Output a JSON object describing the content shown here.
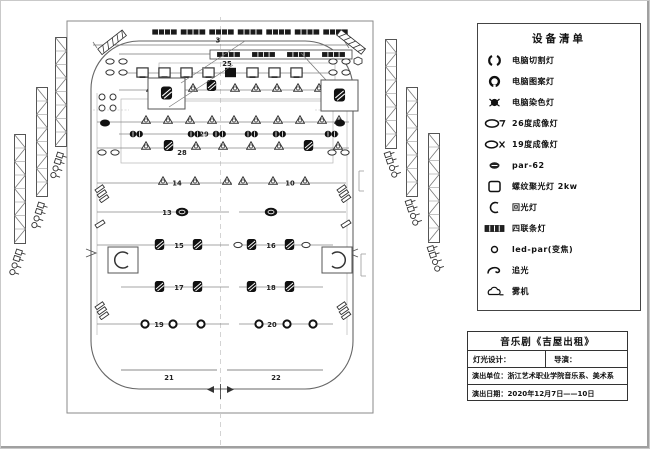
{
  "legend": {
    "title": "设备清单",
    "items": [
      {
        "icon": "computer-cut-light-icon",
        "label": "电脑切割灯"
      },
      {
        "icon": "computer-pattern-light-icon",
        "label": "电脑图案灯"
      },
      {
        "icon": "computer-wash-light-icon",
        "label": "电脑染色灯"
      },
      {
        "icon": "profile-26-deg-icon",
        "label": "26度成像灯"
      },
      {
        "icon": "profile-19-deg-icon",
        "label": "19度成像灯"
      },
      {
        "icon": "par62-icon",
        "label": "par-62"
      },
      {
        "icon": "fresnel-2kw-icon",
        "label": "螺纹聚光灯 2kw"
      },
      {
        "icon": "beam-light-icon",
        "label": "回光灯"
      },
      {
        "icon": "four-cell-strip-icon",
        "label": "四联条灯"
      },
      {
        "icon": "led-par-zoom-icon",
        "label": "led-par(变焦)"
      },
      {
        "icon": "follow-spot-icon",
        "label": "追光"
      },
      {
        "icon": "fog-machine-icon",
        "label": "雾机"
      }
    ]
  },
  "title_block": {
    "show_title": "音乐剧《吉屋出租》",
    "lighting_designer_label": "灯光设计：",
    "director_label": "导演：",
    "company_label": "演出单位：浙江艺术职业学院音乐系、美术系",
    "date_label": "演出日期：2020年12月7日——10日"
  },
  "plan": {
    "labels": {
      "dim3": "3",
      "strip25": "25",
      "par29": "29",
      "b28": "28",
      "b14": "14",
      "b10": "10",
      "b13": "13",
      "b15": "15",
      "b16": "16",
      "b17": "17",
      "b18": "18",
      "b19": "19",
      "b20": "20",
      "b21": "21",
      "b22": "22"
    }
  }
}
